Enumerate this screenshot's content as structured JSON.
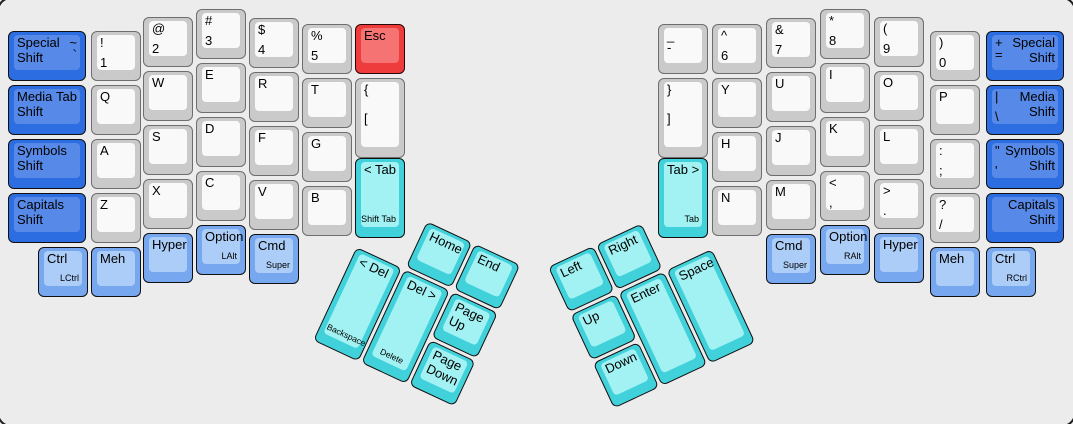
{
  "canvas": {
    "width": 1073,
    "height": 424,
    "background": "#ececec",
    "border_color": "#1c1c1c"
  },
  "palette": {
    "gray": {
      "base": "#cacaca",
      "face": "#f9f9f9",
      "border": "#6e6e6e"
    },
    "blue": {
      "base": "#2c6de2",
      "face": "#578ae8",
      "border": "#101010"
    },
    "ltblue": {
      "base": "#77a7ef",
      "face": "#accdf7",
      "border": "#101010"
    },
    "cyan": {
      "base": "#41d1da",
      "face": "#a2f2f3",
      "border": "#101010"
    },
    "red": {
      "base": "#ee3b3b",
      "face": "#f67373",
      "border": "#2a0606"
    }
  },
  "clusters": {
    "left": {
      "x": 379,
      "y": 199,
      "angle": 25
    },
    "right": {
      "x": 548,
      "y": 267,
      "angle": -25
    }
  },
  "keys": [
    {
      "id": "special-shift-left",
      "x": 8,
      "y": 31,
      "w": 78,
      "color": "blue",
      "legends": {
        "mainl": "Special Shift",
        "tr": "~",
        "tr2": "`"
      }
    },
    {
      "id": "media-shift-left",
      "x": 8,
      "y": 85,
      "w": 78,
      "color": "blue",
      "legends": {
        "mainl": "Media Shift",
        "tr": "Tab"
      }
    },
    {
      "id": "symbols-shift-left",
      "x": 8,
      "y": 139,
      "w": 78,
      "color": "blue",
      "legends": {
        "mainl": "Symbols Shift"
      }
    },
    {
      "id": "capitals-shift-left",
      "x": 8,
      "y": 193,
      "w": 78,
      "color": "blue",
      "legends": {
        "mainl": "Capitals Shift"
      }
    },
    {
      "id": "exclam-1",
      "x": 91,
      "y": 31,
      "color": "gray",
      "legends": {
        "tl": "!",
        "bl": "1"
      }
    },
    {
      "id": "q",
      "x": 91,
      "y": 85,
      "color": "gray",
      "legends": {
        "tl": "Q"
      }
    },
    {
      "id": "a",
      "x": 91,
      "y": 139,
      "color": "gray",
      "legends": {
        "tl": "A"
      }
    },
    {
      "id": "z",
      "x": 91,
      "y": 193,
      "color": "gray",
      "legends": {
        "tl": "Z"
      }
    },
    {
      "id": "at-2",
      "x": 143,
      "y": 17,
      "color": "gray",
      "legends": {
        "tl": "@",
        "bl": "2"
      }
    },
    {
      "id": "w",
      "x": 143,
      "y": 71,
      "color": "gray",
      "legends": {
        "tl": "W"
      }
    },
    {
      "id": "s",
      "x": 143,
      "y": 125,
      "color": "gray",
      "legends": {
        "tl": "S"
      }
    },
    {
      "id": "x",
      "x": 143,
      "y": 179,
      "color": "gray",
      "legends": {
        "tl": "X"
      }
    },
    {
      "id": "hash-3",
      "x": 196,
      "y": 9,
      "color": "gray",
      "legends": {
        "tl": "#",
        "bl": "3"
      }
    },
    {
      "id": "e",
      "x": 196,
      "y": 63,
      "color": "gray",
      "legends": {
        "tl": "E"
      }
    },
    {
      "id": "d",
      "x": 196,
      "y": 117,
      "color": "gray",
      "legends": {
        "tl": "D"
      }
    },
    {
      "id": "c",
      "x": 196,
      "y": 171,
      "color": "gray",
      "legends": {
        "tl": "C"
      }
    },
    {
      "id": "dollar-4",
      "x": 249,
      "y": 18,
      "color": "gray",
      "legends": {
        "tl": "$",
        "bl": "4"
      }
    },
    {
      "id": "r",
      "x": 249,
      "y": 72,
      "color": "gray",
      "legends": {
        "tl": "R"
      }
    },
    {
      "id": "f",
      "x": 249,
      "y": 126,
      "color": "gray",
      "legends": {
        "tl": "F"
      }
    },
    {
      "id": "v",
      "x": 249,
      "y": 180,
      "color": "gray",
      "legends": {
        "tl": "V"
      }
    },
    {
      "id": "percent-5",
      "x": 302,
      "y": 24,
      "color": "gray",
      "legends": {
        "tl": "%",
        "bl": "5"
      }
    },
    {
      "id": "t",
      "x": 302,
      "y": 78,
      "color": "gray",
      "legends": {
        "tl": "T"
      }
    },
    {
      "id": "g",
      "x": 302,
      "y": 132,
      "color": "gray",
      "legends": {
        "tl": "G"
      }
    },
    {
      "id": "b",
      "x": 302,
      "y": 186,
      "color": "gray",
      "legends": {
        "tl": "B"
      }
    },
    {
      "id": "esc",
      "x": 355,
      "y": 24,
      "color": "red",
      "legends": {
        "tl": "Esc"
      }
    },
    {
      "id": "brace-bracket-left",
      "x": 355,
      "y": 78,
      "h": 80,
      "color": "gray",
      "legends": {
        "tl": "{",
        "ml": "["
      }
    },
    {
      "id": "tab-left",
      "x": 355,
      "y": 158,
      "h": 80,
      "color": "cyan",
      "legends": {
        "tl": "< Tab",
        "br": "Shift Tab"
      }
    },
    {
      "id": "ctrl-left",
      "x": 38,
      "y": 247,
      "color": "ltblue",
      "legends": {
        "tl": "Ctrl",
        "br": "LCtrl"
      }
    },
    {
      "id": "meh-left",
      "x": 91,
      "y": 247,
      "color": "ltblue",
      "legends": {
        "tl": "Meh"
      }
    },
    {
      "id": "hyper-left",
      "x": 143,
      "y": 233,
      "color": "ltblue",
      "legends": {
        "tl": "Hyper"
      }
    },
    {
      "id": "option-left",
      "x": 196,
      "y": 225,
      "color": "ltblue",
      "legends": {
        "tl": "Option",
        "br": "LAlt"
      }
    },
    {
      "id": "cmd-left",
      "x": 249,
      "y": 234,
      "color": "ltblue",
      "legends": {
        "tl": "Cmd",
        "br": "Super"
      }
    },
    {
      "id": "underscore-dash",
      "x": 658,
      "y": 24,
      "color": "gray",
      "legends": {
        "tl": "_",
        "tl2": "-"
      }
    },
    {
      "id": "brace-bracket-right",
      "x": 658,
      "y": 78,
      "h": 80,
      "color": "gray",
      "legends": {
        "tl": "}",
        "ml": "]"
      }
    },
    {
      "id": "tab-right",
      "x": 658,
      "y": 158,
      "h": 80,
      "color": "cyan",
      "legends": {
        "tl": "Tab >",
        "br": "Tab"
      }
    },
    {
      "id": "caret-6",
      "x": 712,
      "y": 24,
      "color": "gray",
      "legends": {
        "tl": "^",
        "bl": "6"
      }
    },
    {
      "id": "y",
      "x": 712,
      "y": 78,
      "color": "gray",
      "legends": {
        "tl": "Y"
      }
    },
    {
      "id": "h",
      "x": 712,
      "y": 132,
      "color": "gray",
      "legends": {
        "tl": "H"
      }
    },
    {
      "id": "n",
      "x": 712,
      "y": 186,
      "color": "gray",
      "legends": {
        "tl": "N"
      }
    },
    {
      "id": "amp-7",
      "x": 766,
      "y": 18,
      "color": "gray",
      "legends": {
        "tl": "&",
        "bl": "7"
      }
    },
    {
      "id": "u",
      "x": 766,
      "y": 72,
      "color": "gray",
      "legends": {
        "tl": "U"
      }
    },
    {
      "id": "j",
      "x": 766,
      "y": 126,
      "color": "gray",
      "legends": {
        "tl": "J"
      }
    },
    {
      "id": "m",
      "x": 766,
      "y": 180,
      "color": "gray",
      "legends": {
        "tl": "M"
      }
    },
    {
      "id": "asterisk-8",
      "x": 820,
      "y": 9,
      "color": "gray",
      "legends": {
        "tl": "*",
        "bl": "8"
      }
    },
    {
      "id": "i",
      "x": 820,
      "y": 63,
      "color": "gray",
      "legends": {
        "tl": "I"
      }
    },
    {
      "id": "k",
      "x": 820,
      "y": 117,
      "color": "gray",
      "legends": {
        "tl": "K"
      }
    },
    {
      "id": "lt-comma",
      "x": 820,
      "y": 171,
      "color": "gray",
      "legends": {
        "tl": "<",
        "bl": ","
      }
    },
    {
      "id": "paren-9",
      "x": 874,
      "y": 17,
      "color": "gray",
      "legends": {
        "tl": "(",
        "bl": "9"
      }
    },
    {
      "id": "o",
      "x": 874,
      "y": 71,
      "color": "gray",
      "legends": {
        "tl": "O"
      }
    },
    {
      "id": "l",
      "x": 874,
      "y": 125,
      "color": "gray",
      "legends": {
        "tl": "L"
      }
    },
    {
      "id": "gt-period",
      "x": 874,
      "y": 179,
      "color": "gray",
      "legends": {
        "tl": ">",
        "bl": "."
      }
    },
    {
      "id": "paren-0",
      "x": 930,
      "y": 31,
      "color": "gray",
      "legends": {
        "tl": ")",
        "bl": "0"
      }
    },
    {
      "id": "p",
      "x": 930,
      "y": 85,
      "color": "gray",
      "legends": {
        "tl": "P"
      }
    },
    {
      "id": "colon-semicolon",
      "x": 930,
      "y": 139,
      "color": "gray",
      "legends": {
        "tl": ":",
        "bl": ";"
      }
    },
    {
      "id": "question-slash",
      "x": 930,
      "y": 193,
      "color": "gray",
      "legends": {
        "tl": "?",
        "bl": "/"
      }
    },
    {
      "id": "special-shift-right",
      "x": 986,
      "y": 31,
      "w": 78,
      "color": "blue",
      "legends": {
        "mainr": "Special Shift",
        "tl": "+",
        "tl2": "="
      }
    },
    {
      "id": "media-shift-right",
      "x": 986,
      "y": 85,
      "w": 78,
      "color": "blue",
      "legends": {
        "mainr": "Media Shift",
        "tl": "|",
        "bl": "\\"
      }
    },
    {
      "id": "symbols-shift-right",
      "x": 986,
      "y": 139,
      "w": 78,
      "color": "blue",
      "legends": {
        "mainr": "Symbols Shift",
        "tl": "\"",
        "bl": "'"
      }
    },
    {
      "id": "capitals-shift-right",
      "x": 986,
      "y": 193,
      "w": 78,
      "color": "blue",
      "legends": {
        "mainr": "Capitals Shift"
      }
    },
    {
      "id": "cmd-right",
      "x": 766,
      "y": 234,
      "color": "ltblue",
      "legends": {
        "tl": "Cmd",
        "br": "Super"
      }
    },
    {
      "id": "option-right",
      "x": 820,
      "y": 225,
      "color": "ltblue",
      "legends": {
        "tl": "Option",
        "br": "RAlt"
      }
    },
    {
      "id": "hyper-right",
      "x": 874,
      "y": 233,
      "color": "ltblue",
      "legends": {
        "tl": "Hyper"
      }
    },
    {
      "id": "meh-right",
      "x": 930,
      "y": 247,
      "color": "ltblue",
      "legends": {
        "tl": "Meh"
      }
    },
    {
      "id": "ctrl-right",
      "x": 986,
      "y": 247,
      "color": "ltblue",
      "legends": {
        "tl": "Ctrl",
        "br": "RCtrl"
      }
    },
    {
      "id": "home",
      "cluster": "left",
      "x": 53,
      "y": 0,
      "color": "cyan",
      "legends": {
        "tl": "Home"
      }
    },
    {
      "id": "end",
      "cluster": "left",
      "x": 106,
      "y": 0,
      "color": "cyan",
      "legends": {
        "tl": "End"
      }
    },
    {
      "id": "backspace",
      "cluster": "left",
      "x": 0,
      "y": 53,
      "h": 103,
      "color": "cyan",
      "legends": {
        "tl": "< Del",
        "bc": "Backspace"
      }
    },
    {
      "id": "delete",
      "cluster": "left",
      "x": 53,
      "y": 53,
      "h": 103,
      "color": "cyan",
      "legends": {
        "tl": "Del >",
        "bc": "Delete"
      }
    },
    {
      "id": "page-up",
      "cluster": "left",
      "x": 106,
      "y": 53,
      "color": "cyan",
      "legends": {
        "tl": "Page Up"
      }
    },
    {
      "id": "page-down",
      "cluster": "left",
      "x": 106,
      "y": 106,
      "color": "cyan",
      "legends": {
        "tl": "Page Down"
      }
    },
    {
      "id": "arrow-left",
      "cluster": "right",
      "x": 0,
      "y": 0,
      "color": "cyan",
      "legends": {
        "tl": "Left"
      }
    },
    {
      "id": "arrow-right",
      "cluster": "right",
      "x": 53,
      "y": 0,
      "color": "cyan",
      "legends": {
        "tl": "Right"
      }
    },
    {
      "id": "arrow-up",
      "cluster": "right",
      "x": 0,
      "y": 53,
      "color": "cyan",
      "legends": {
        "tl": "Up"
      }
    },
    {
      "id": "arrow-down",
      "cluster": "right",
      "x": 0,
      "y": 106,
      "color": "cyan",
      "legends": {
        "tl": "Down"
      }
    },
    {
      "id": "enter",
      "cluster": "right",
      "x": 53,
      "y": 53,
      "h": 103,
      "color": "cyan",
      "legends": {
        "tl": "Enter"
      }
    },
    {
      "id": "space",
      "cluster": "right",
      "x": 106,
      "y": 53,
      "h": 103,
      "color": "cyan",
      "legends": {
        "tl": "Space"
      }
    }
  ]
}
